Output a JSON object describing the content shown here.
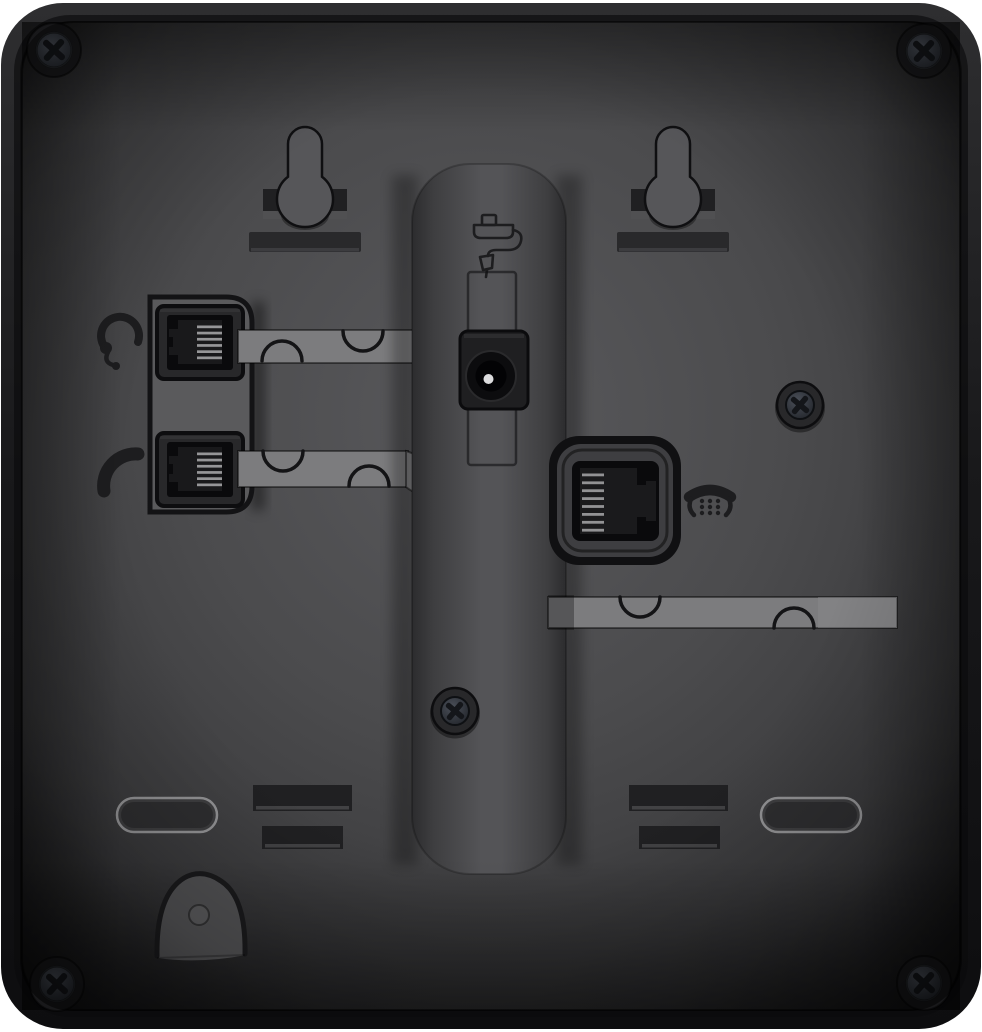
{
  "scene": {
    "type": "product-photo",
    "subject": "Rear panel of a black desk telephone",
    "view": "back",
    "background": "white"
  },
  "colors": {
    "bg": "#ffffff",
    "body_top": "#2e2e30",
    "body_mid": "#19191b",
    "body_dark": "#0d0d0f",
    "face_light": "#59595c",
    "face_mid": "#4b4b4d",
    "face_dark": "#232325",
    "plate": "#5a5a5c",
    "channel": "#7c7c7e",
    "column_light": "#545457",
    "column_edge": "#2c2c2e",
    "slot_dark": "#202022",
    "bar_dark": "#29292b",
    "port_frame": "#28282a",
    "port_black": "#0a0a0c",
    "pin_light": "#a8a8aa",
    "bezel_ring": "#3e3e41",
    "icon_dark": "#1d1d1f",
    "outline_dark": "#131315",
    "screw_slot": "#14161a",
    "foot_fill": "#3e3e40",
    "foot_rim": "#939395",
    "keyhole_fill": "#565659",
    "recess_fill": "#515153"
  },
  "ports": [
    {
      "id": "headset-port",
      "icon": "headset-icon",
      "jack": "modular-jack",
      "position": "upper-left"
    },
    {
      "id": "handset-port",
      "icon": "handset-icon",
      "jack": "modular-jack",
      "position": "lower-left"
    },
    {
      "id": "power-jack",
      "icon": "power-adapter-icon",
      "jack": "dc-barrel",
      "position": "center"
    },
    {
      "id": "line-port",
      "icon": "telephone-icon",
      "jack": "modular-jack",
      "position": "center-right"
    }
  ],
  "features": {
    "wall_mount_keyholes": 2,
    "mounting_bars": 2,
    "screws": 6,
    "cable_channels": 3,
    "cable_clip_notches": 6,
    "vent_slots": 4,
    "rubber_feet": 2,
    "handset_hook_recess": 1,
    "stand_rail": 1
  }
}
